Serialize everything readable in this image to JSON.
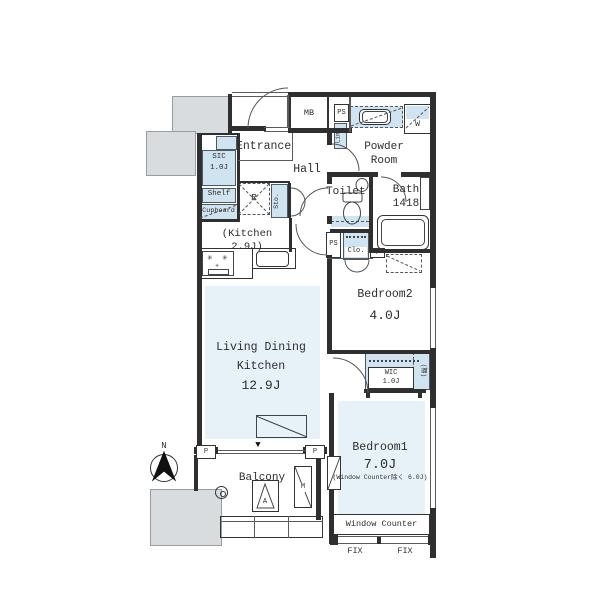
{
  "colors": {
    "floor_tint": "#e7f1f8",
    "storage_tint": "#cfe3f0",
    "structure_gray": "#d9dcde",
    "wall": "#2f2f2f"
  },
  "rooms": {
    "entrance": {
      "label": "Entrance"
    },
    "hall": {
      "label": "Hall"
    },
    "powder_room": {
      "label": "Powder\nRoom"
    },
    "toilet": {
      "label": "Toilet"
    },
    "bath": {
      "label": "Bath\n1418"
    },
    "kitchen": {
      "label": "(Kitchen 2.9J)"
    },
    "ldk": {
      "line1": "Living Dining",
      "line2": "Kitchen",
      "size": "12.9J"
    },
    "bedroom2": {
      "label": "Bedroom2",
      "size": "4.0J"
    },
    "bedroom1": {
      "label": "Bedroom1",
      "size": "7.0J",
      "note": "(Window Counter除く 6.0J)"
    },
    "balcony": {
      "label": "Balcony"
    },
    "window_counter": {
      "label": "Window Counter"
    }
  },
  "storage": {
    "sic": {
      "label": "SIC\n1.0J"
    },
    "shelf": {
      "label": "Shelf"
    },
    "cupboard": {
      "label": "Cupboard"
    },
    "refrigerator": {
      "label": "R"
    },
    "sto": {
      "label": "Sto."
    },
    "linen": {
      "label": "Lin."
    },
    "closet": {
      "label": "Clo."
    },
    "wic": {
      "label": "WIC\n1.0J"
    },
    "wic_shelf": {
      "label": "(棚)"
    }
  },
  "equipment": {
    "meter_box": "MB",
    "ps_top": "PS",
    "ps_mid": "PS",
    "washer": "W",
    "pillar_small": "P",
    "pillar_left": "P",
    "pillar_right": "P",
    "hatch": "A",
    "meter": "M"
  },
  "windows": {
    "fix_left": "FIX",
    "fix_right": "FIX"
  },
  "compass": {
    "north": "N"
  },
  "icons": {
    "burner": "✳",
    "door_marker": "▼"
  }
}
